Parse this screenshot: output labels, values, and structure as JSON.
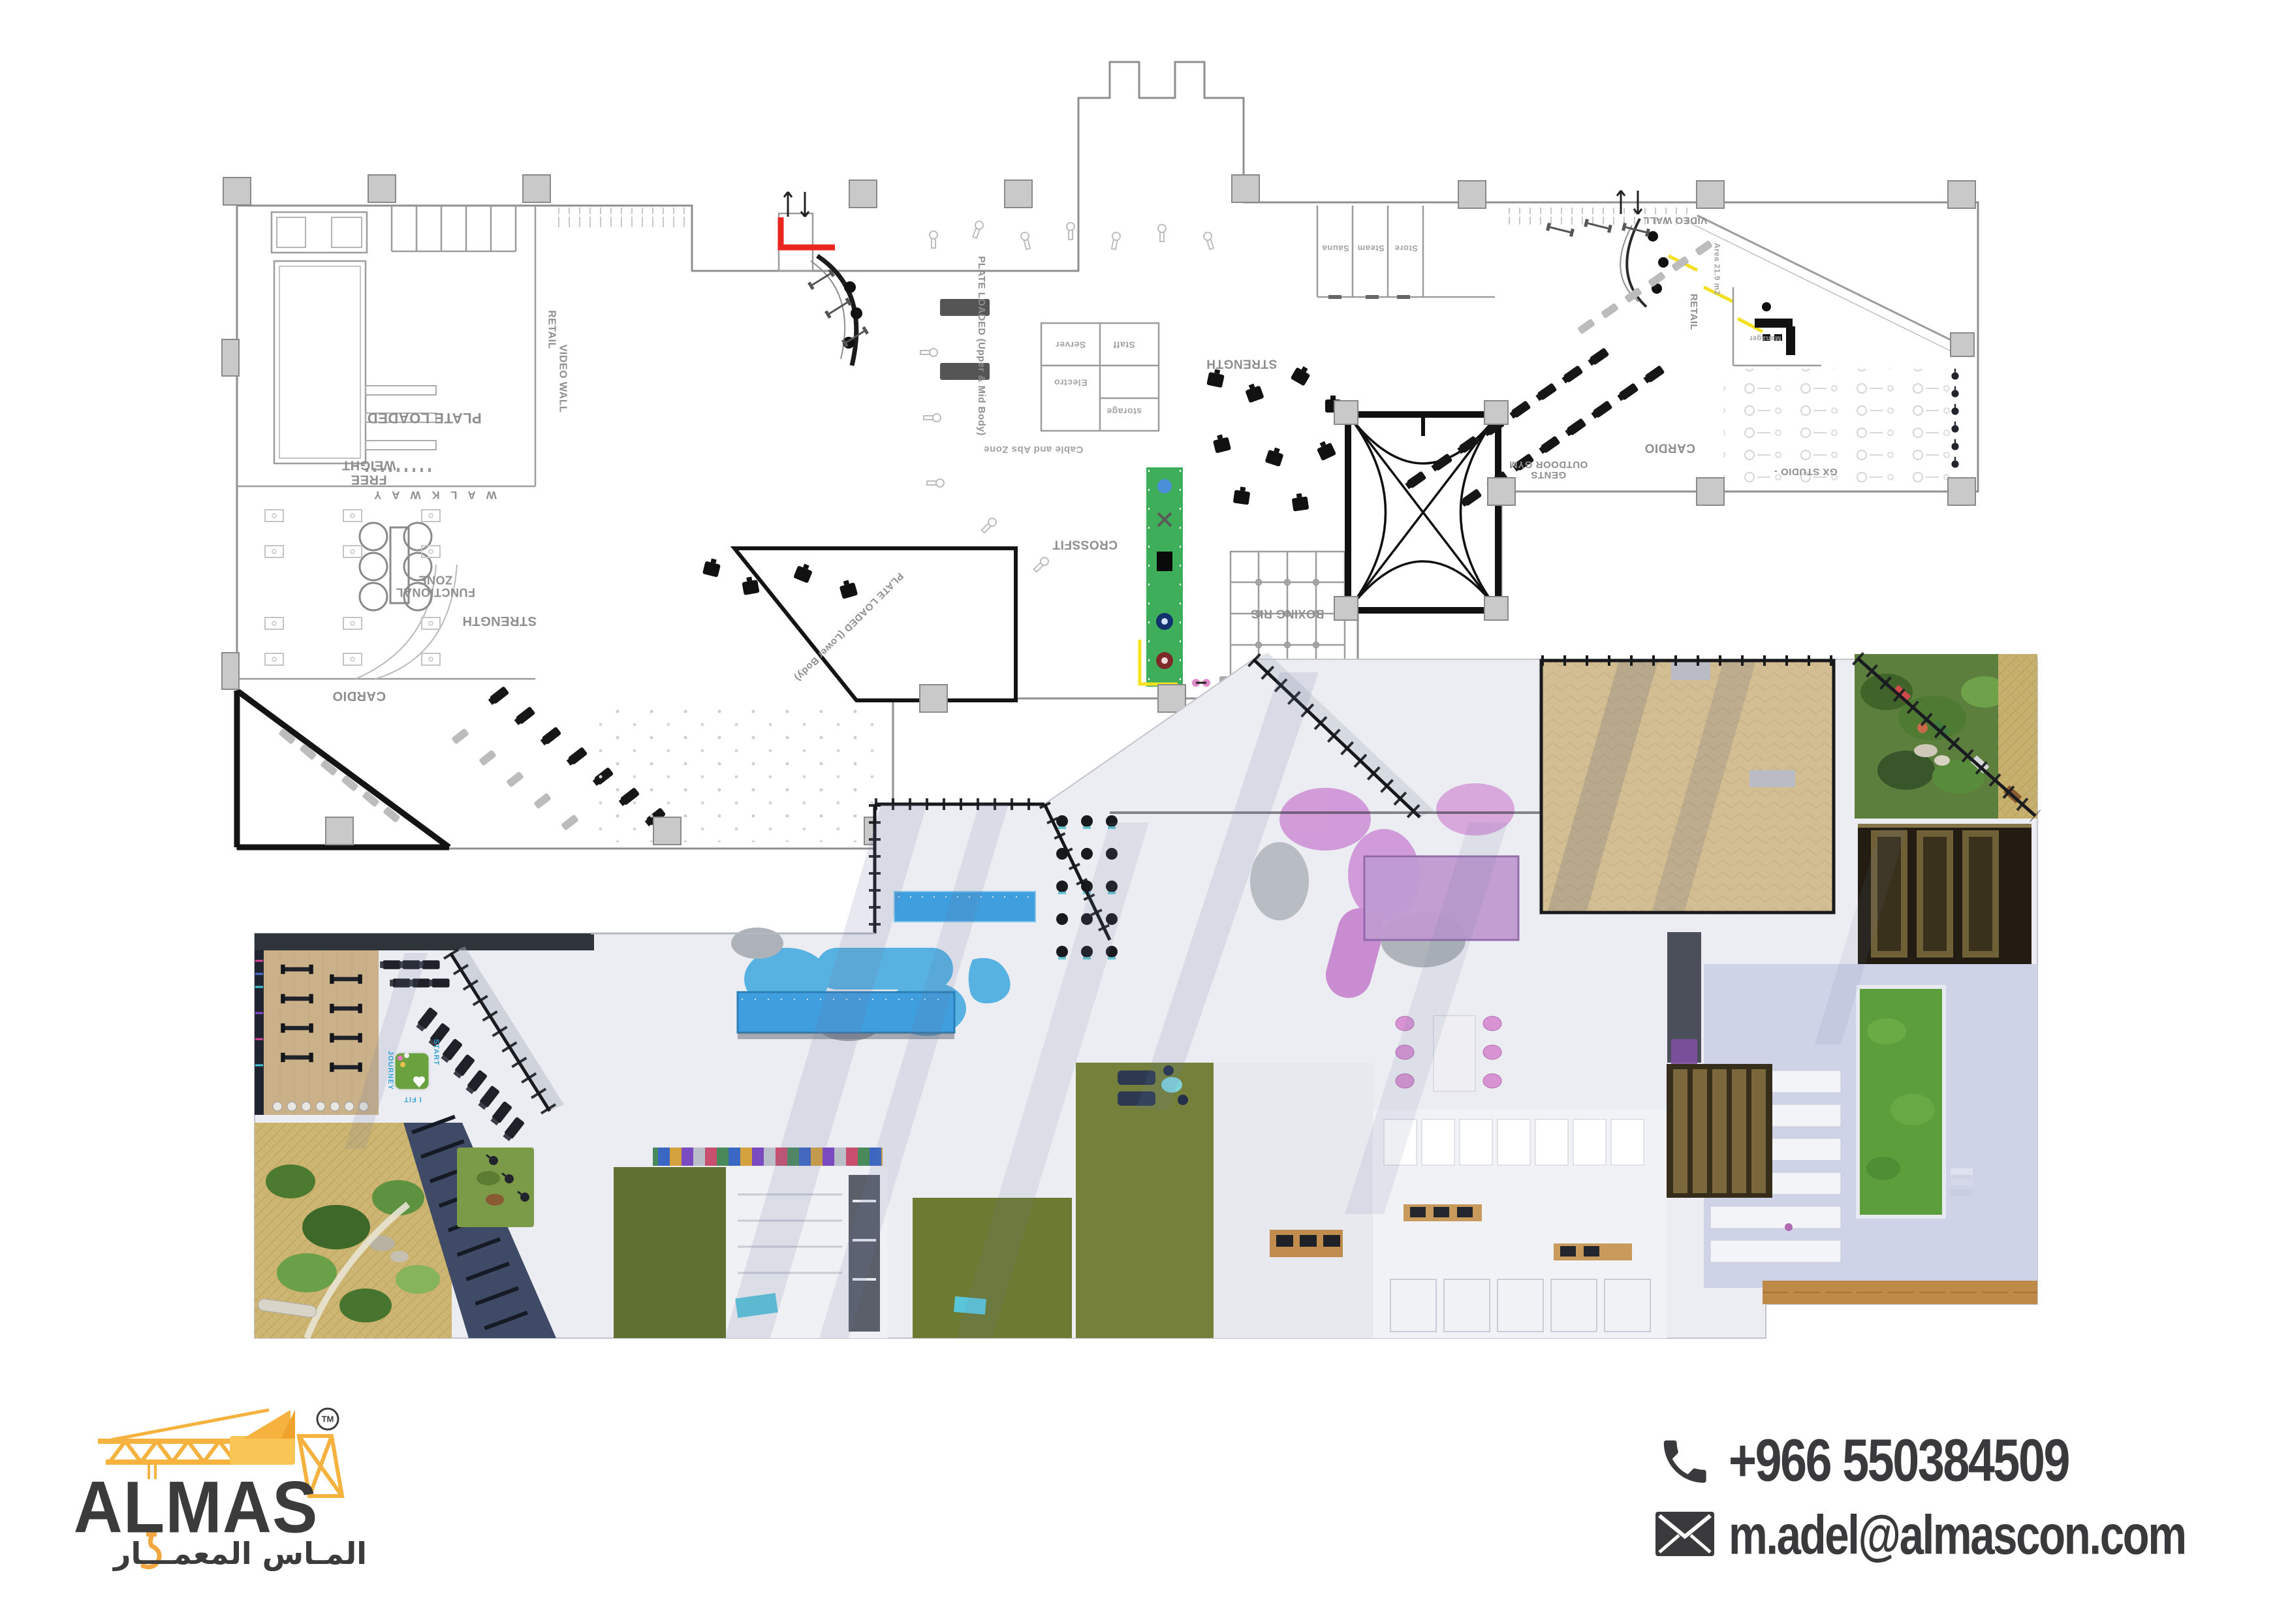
{
  "branding": {
    "name": "ALMAS",
    "arabic": "المـاس المعمـــار",
    "tm": "TM"
  },
  "contact": {
    "phone": "+966 550384509",
    "email": "m.adel@almascon.com"
  },
  "plan": {
    "labels": {
      "plate_loaded": "PLATE LOADED",
      "free_weight": "FREE\nWEIGHT",
      "walk_way": "W A L K   W A Y",
      "retail_left": "RETAIL",
      "video_wall_left": "VIDEO WALL",
      "functional_zone": "FUNCTIONAL\nZONE",
      "strength_left": "STRENGTH",
      "cardio_left": "CARDIO",
      "cable_abs": "Cable and Abs Zone",
      "plate_loaded_upper": "PLATE LOADED (Upper & Mid Body)",
      "plate_loaded_lower": "PLATE LOADED (Lower Body)",
      "crossfit": "CROSSFIT",
      "boxing_rig": "BOXING RIG",
      "server": "Server",
      "electro": "Electro",
      "staff": "Staff",
      "storage": "storage",
      "strength_mid": "STRENGTH",
      "sauna": "Sauna",
      "steam": "Steam",
      "store": "Store",
      "video_wall_right": "VIDEO WALL",
      "retail_right": "RETAIL",
      "area_right": "Area 21.9 m2",
      "manager": "Manager",
      "cardio_right": "CARDIO",
      "gents_outdoor": "GENTS\nOUTDOOR GYM",
      "gx_studio": "GX STUDIO -"
    }
  },
  "render": {
    "floor_texts": {
      "start": "START",
      "journey": "JOURNEY",
      "i_fit": "I FIT"
    }
  },
  "colors": {
    "crane_yellow": "#F6B23E",
    "turf_green": "#3FAE5A",
    "highlight_red": "#E8251F",
    "highlight_yellow": "#F7E11E",
    "text_dark": "#3B3B3C"
  }
}
